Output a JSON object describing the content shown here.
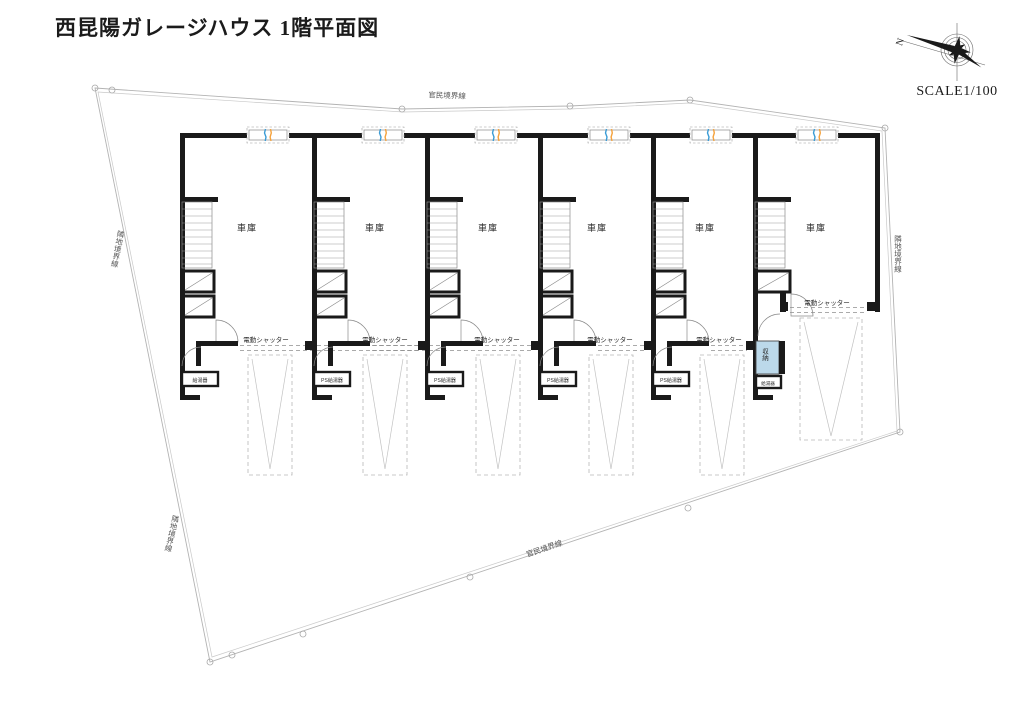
{
  "title": "西昆陽ガレージハウス 1階平面図",
  "scale_label": "SCALE1/100",
  "compass": {
    "north_label": "N"
  },
  "boundaries": {
    "top": "官民境界線",
    "bottom": "官民境界線",
    "left": "隣地境界線",
    "right": "隣地境界線",
    "bottom_left": "隣地境界線"
  },
  "units": [
    {
      "name": "車庫",
      "shutter": "電動シャッター",
      "equipment": "給湯器"
    },
    {
      "name": "車庫",
      "shutter": "電動シャッター",
      "equipment": "PS給湯器"
    },
    {
      "name": "車庫",
      "shutter": "電動シャッター",
      "equipment": "PS給湯器"
    },
    {
      "name": "車庫",
      "shutter": "電動シャッター",
      "equipment": "PS給湯器"
    },
    {
      "name": "車庫",
      "shutter": "電動シャッター",
      "equipment": "PS給湯器"
    },
    {
      "name": "車庫",
      "shutter": "電動シャッター",
      "equipment": "給湯器",
      "storage": "収納"
    }
  ],
  "colors": {
    "wall": "#1a1a1a",
    "storage_fill": "#bcd9ea",
    "window_mark_blue": "#3a9bd5",
    "window_mark_orange": "#f5a23c"
  }
}
